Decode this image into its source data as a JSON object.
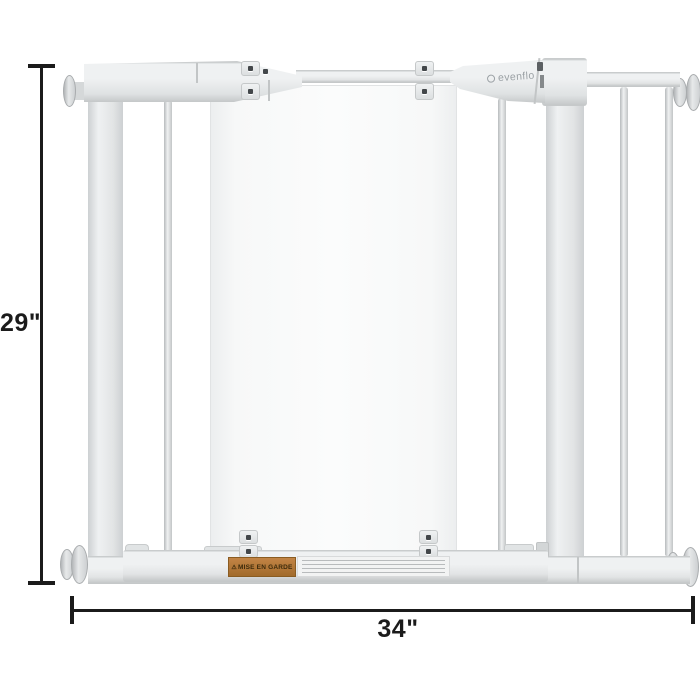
{
  "dimensions": {
    "height": {
      "label": "29\""
    },
    "width": {
      "label": "34\""
    }
  },
  "gate": {
    "brand_logo": "evenflo",
    "warning_label": {
      "icon": "⚠",
      "text": "MISE EN GARDE"
    }
  },
  "colors": {
    "background": "#ffffff",
    "metal_light": "#eff1f2",
    "metal_mid": "#e2e4e5",
    "metal_shadow": "#cdd0d2",
    "metal_edge": "#b7babc",
    "panel_fill": "#f7f8f8",
    "dimension_line": "#1b1b1b",
    "warning_bg": "#b47a38",
    "warning_text": "#3c2a0b",
    "logo_text": "#9ba1a5",
    "screw": "#43474a",
    "fineprint_bg": "#f2f3f3"
  }
}
